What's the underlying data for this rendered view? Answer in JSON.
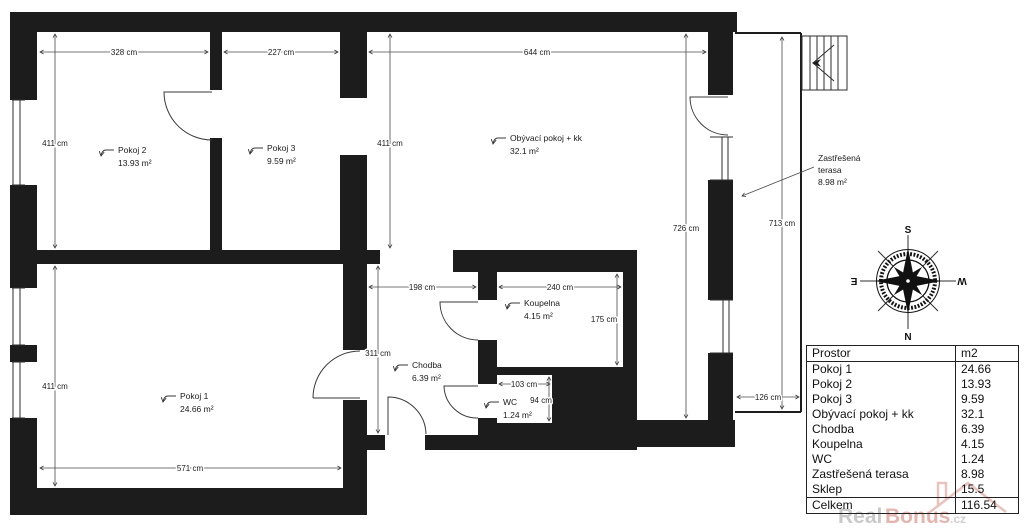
{
  "rooms": {
    "pokoj2": {
      "label": "Pokoj 2",
      "area": "13.93 m²"
    },
    "pokoj3": {
      "label": "Pokoj 3",
      "area": "9.59 m²"
    },
    "living": {
      "label": "Obývací pokoj + kk",
      "area": "32.1 m²"
    },
    "pokoj1": {
      "label": "Pokoj 1",
      "area": "24.66 m²"
    },
    "chodba": {
      "label": "Chodba",
      "area": "6.39 m²"
    },
    "koupelna": {
      "label": "Koupelna",
      "area": "4.15 m²"
    },
    "wc": {
      "label": "WC",
      "area": "1.24 m²"
    },
    "terasa": {
      "line1": "Zastřešená",
      "line2": "terasa",
      "area": "8.98 m²"
    }
  },
  "dims": {
    "pokoj2_w": "328 cm",
    "pokoj3_w": "227 cm",
    "living_w": "644 cm",
    "pokoj2_h": "411 cm",
    "mid_h": "411 cm",
    "pokoj1_h": "411 cm",
    "living_h": "726 cm",
    "terasa_h": "713 cm",
    "chodba_w": "198 cm",
    "koupelna_w": "240 cm",
    "koupelna_h": "175 cm",
    "chodba_h": "311 cm",
    "wc_w": "103 cm",
    "wc_h": "94 cm",
    "pokoj1_w": "571 cm",
    "terasa_w": "126 cm"
  },
  "compass": {
    "top": "S",
    "bottom": "N",
    "left": "E",
    "right": "W"
  },
  "table": {
    "header": {
      "name": "Prostor",
      "unit": "m2"
    },
    "rows": [
      {
        "label": "Pokoj 1",
        "value": "24.66"
      },
      {
        "label": "Pokoj 2",
        "value": "13.93"
      },
      {
        "label": "Pokoj 3",
        "value": "9.59"
      },
      {
        "label": "Obývací pokoj + kk",
        "value": "32.1"
      },
      {
        "label": "Chodba",
        "value": "6.39"
      },
      {
        "label": "Koupelna",
        "value": "4.15"
      },
      {
        "label": "WC",
        "value": "1.24"
      },
      {
        "label": "Zastřešená terasa",
        "value": "8.98"
      },
      {
        "label": "Sklep",
        "value": "15.5"
      }
    ],
    "total": {
      "label": "Celkem",
      "value": "116.54"
    }
  },
  "watermark": {
    "part1": "Real",
    "part2": "Bonus",
    "suffix": ".cz"
  }
}
